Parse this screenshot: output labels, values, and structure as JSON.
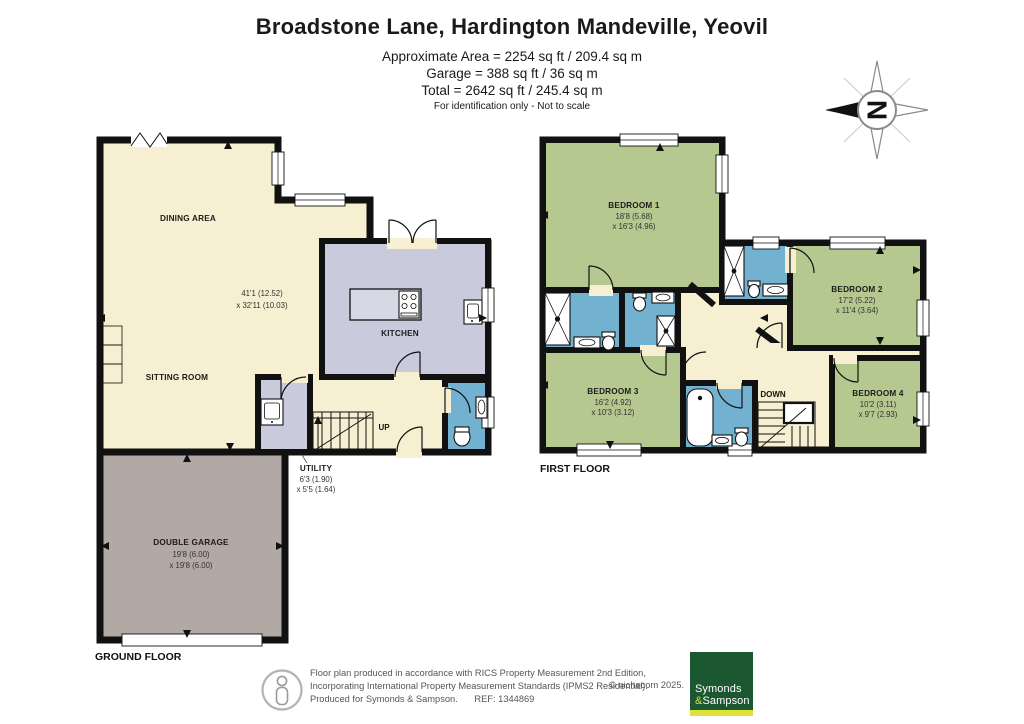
{
  "header": {
    "title": "Broadstone Lane, Hardington Mandeville, Yeovil",
    "area_line1": "Approximate Area = 2254 sq ft / 209.4 sq m",
    "area_line2": "Garage = 388 sq ft / 36 sq m",
    "area_line3": "Total = 2642 sq ft / 245.4 sq m",
    "disclaimer": "For identification only - Not to scale"
  },
  "compass": {
    "north_letter": "N"
  },
  "ground_floor": {
    "floor_label": "GROUND FLOOR",
    "stairs_label": "UP",
    "rooms": {
      "dining_area": {
        "name": "DINING AREA"
      },
      "sitting_room": {
        "name": "SITTING ROOM"
      },
      "open_plan_dims": {
        "line1": "41'1 (12.52)",
        "line2": "x 32'11 (10.03)"
      },
      "kitchen": {
        "name": "KITCHEN"
      },
      "utility": {
        "name": "UTILITY",
        "dims1": "6'3 (1.90)",
        "dims2": "x 5'5 (1.64)"
      },
      "double_garage": {
        "name": "DOUBLE GARAGE",
        "dims1": "19'8 (6.00)",
        "dims2": "x 19'8 (6.00)"
      }
    }
  },
  "first_floor": {
    "floor_label": "FIRST FLOOR",
    "stairs_label": "DOWN",
    "rooms": {
      "bedroom1": {
        "name": "BEDROOM 1",
        "dims1": "18'8 (5.68)",
        "dims2": "x 16'3 (4.96)"
      },
      "bedroom2": {
        "name": "BEDROOM 2",
        "dims1": "17'2 (5.22)",
        "dims2": "x 11'4 (3.64)"
      },
      "bedroom3": {
        "name": "BEDROOM 3",
        "dims1": "16'2 (4.92)",
        "dims2": "x 10'3 (3.12)"
      },
      "bedroom4": {
        "name": "BEDROOM 4",
        "dims1": "10'2 (3.11)",
        "dims2": "x 9'7 (2.93)"
      }
    }
  },
  "footer": {
    "line1": "Floor plan produced in accordance with RICS Property Measurement 2nd Edition,",
    "line2": "Incorporating International Property Measurement Standards (IPMS2 Residential).",
    "line3": "Produced for Symonds & Sampson.",
    "ref": "REF: 1344869",
    "copyright": "© nichecom 2025.",
    "logo": {
      "line1": "Symonds",
      "amp": "&",
      "line2": "Sampson"
    }
  },
  "colors": {
    "wall": "#111111",
    "room_cream": "#f6efd1",
    "room_lavender": "#c9cbdd",
    "room_green": "#b5c88f",
    "room_blue": "#72b2d0",
    "garage_grey": "#b2a8a4",
    "logo_green": "#1b5731",
    "logo_yellow": "#dde23b"
  }
}
